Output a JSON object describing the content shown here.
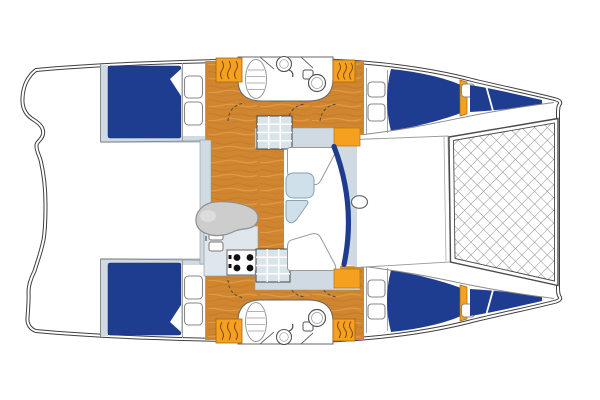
{
  "title": "Catamaran interior layout plan (top view, bow to the right)",
  "diagram_type": "boat-floor-plan",
  "orientation": {
    "bow": "right",
    "stern": "left"
  },
  "colors": {
    "outline": "#3f3f3f",
    "berth_blue": "#1e3d91",
    "wood": "#d0862f",
    "accent_orange": "#f5a01e",
    "deck_pale": "#cfdae3",
    "steps_cell": "#d9e3ea",
    "settee_gray": "#cdcdcd",
    "table_blue": "#cfe0ea",
    "counter_pale": "#dfe7ed",
    "fixture_white": "#ffffff",
    "net_line": "#8f8f8f",
    "burner_black": "#111111"
  },
  "features": {
    "port_hull": {
      "name": "port-hull (top)",
      "rooms": [
        "aft-double-berth",
        "head-with-toilet-basin-vanity",
        "forward-double-berth",
        "forepeak-berth"
      ],
      "windows": 5,
      "step_blocks": 2
    },
    "starboard_hull": {
      "name": "starboard-hull (bottom, mirrored)",
      "rooms": [
        "aft-double-berth",
        "head-with-toilet-basin-vanity",
        "forward-double-berth",
        "forepeak-berth"
      ],
      "windows": 5,
      "step_blocks": 2
    },
    "bridgedeck": [
      "salon-wood-floor",
      "galley-double-sink",
      "galley-stove-4-burners",
      "curved-settee",
      "dinette-benches",
      "dinette-table",
      "companionway-steps-port",
      "companionway-steps-starboard",
      "curved-windshield",
      "mast-base",
      "foredeck"
    ],
    "exterior": [
      "aft-cockpit",
      "stepped-transoms",
      "bow-trampoline-net"
    ]
  }
}
